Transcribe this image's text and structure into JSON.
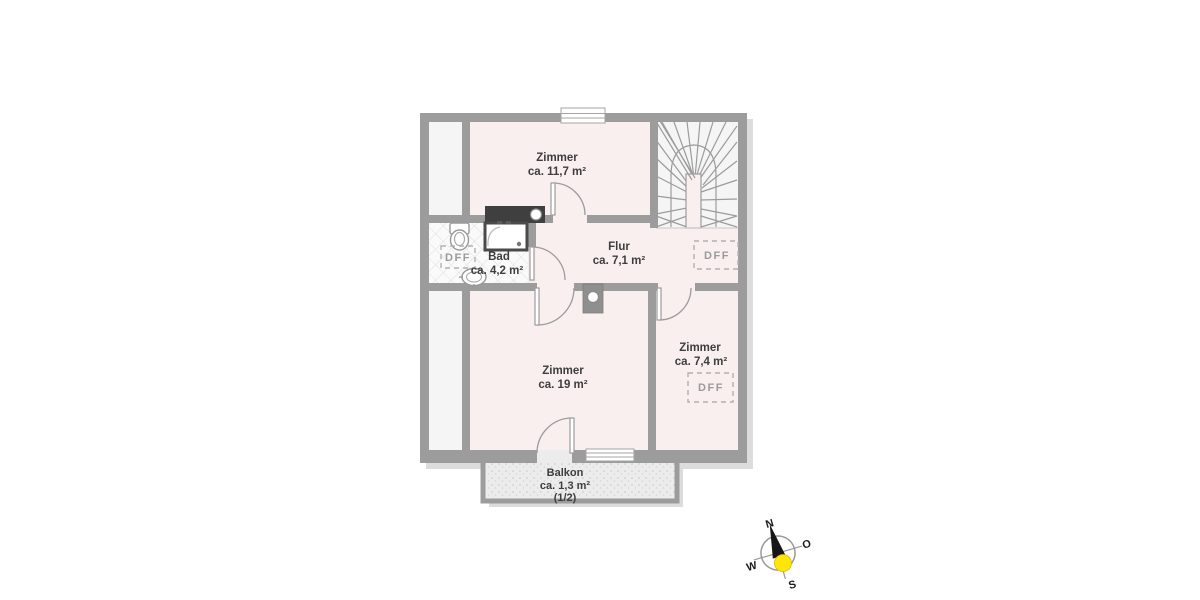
{
  "plan": {
    "type": "floor-plan",
    "rooms": {
      "zimmer_top": {
        "name": "Zimmer",
        "area": "ca. 11,7 m²"
      },
      "flur": {
        "name": "Flur",
        "area": "ca. 7,1 m²"
      },
      "bad": {
        "name": "Bad",
        "area": "ca. 4,2 m²"
      },
      "zimmer_large": {
        "name": "Zimmer",
        "area": "ca. 19 m²"
      },
      "zimmer_right": {
        "name": "Zimmer",
        "area": "ca. 7,4 m²"
      },
      "balkon": {
        "name": "Balkon",
        "area": "ca. 1,3 m²",
        "share": "(1/2)"
      }
    },
    "skylights": {
      "label": "DFF"
    },
    "compass": {
      "north": "N",
      "east": "O",
      "south": "S",
      "west": "W"
    },
    "colors": {
      "wall": "#9c9c9c",
      "room_fill": "#f9efef",
      "side_fill": "#f5f5f5",
      "balcony_fill": "#ececec",
      "dark_block": "#3f3f3f",
      "compass_sun": "#ffe60a",
      "compass_needle": "#161616",
      "label_text": "#3e3e3e",
      "skylight_text": "#9b9b9b"
    }
  }
}
